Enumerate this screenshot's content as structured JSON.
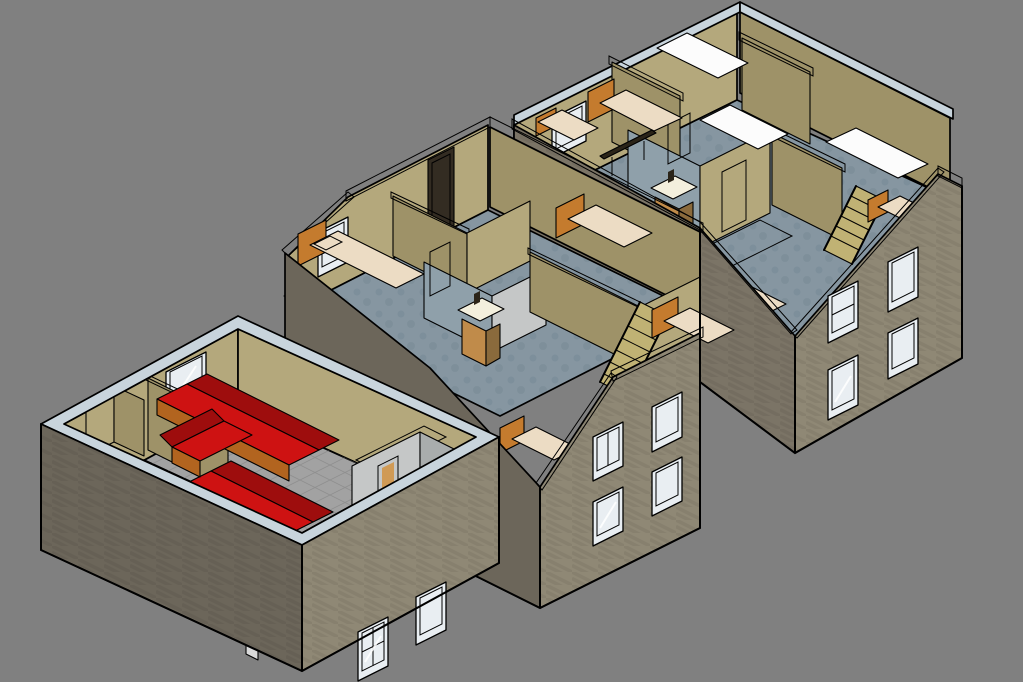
{
  "canvas": {
    "width": 1023,
    "height": 682,
    "background": "#808080"
  },
  "palette": {
    "bg": "#808080",
    "cap": "#c8d4dc",
    "white": "#ffffff",
    "ext_lit": "#8f8875",
    "ext_mid": "#7b7466",
    "ext_shade": "#6c665a",
    "tan_lit": "#b4a87c",
    "tan_shade": "#9e9268",
    "floor_gray": "#a2a2a2",
    "floor_grid": "#7f7f7f",
    "floor_blue": "#8696a1",
    "floor_blue_dark": "#72828c",
    "bath_int": "#8fa0aa",
    "bath_wall": "#c5c7c7",
    "bath_wall_shade": "#a9adad",
    "glass": "#a3b9c9",
    "glass_light": "#c4d1da",
    "glass_dark": "#7e98aa",
    "frame": "#e9eef2",
    "red_seat": "#ce1212",
    "red_back": "#9e0d0d",
    "base_orange": "#b2641f",
    "wood_table": "#c79a66",
    "wood_dark": "#8a6a3c",
    "mattress": "#ecdcc4",
    "headboard": "#c47b2e",
    "white_obj": "#fcfcfc",
    "white_obj_shade": "#d9d9d9",
    "olive": "#b0a245",
    "olive_shade": "#857a2e",
    "olive_door": "#a79a2f",
    "stair_tread": "#c0b274",
    "sink_wood": "#c08b4a",
    "sink_top": "#f3efdd",
    "door_dark": "#332c22",
    "door_glow": "#d09a55",
    "dark_obj": "#2b2418",
    "chair_dark": "#4a3b28"
  },
  "scene": {
    "description": "Isometric SketchUp-style cutaway render of three floors of a house displayed side by side on a gray background",
    "floors": [
      {
        "id": "ground-floor",
        "position": "bottom-left",
        "rooms": [
          "entry hall",
          "living room",
          "kitchen",
          "bathroom"
        ],
        "furniture": [
          "U-shaped red sofa group",
          "two wooden tables with chairs",
          "refrigerator",
          "olive kitchen counter with sink",
          "open double entry door"
        ],
        "windows": 3
      },
      {
        "id": "first-floor",
        "position": "middle",
        "rooms": [
          "bedroom",
          "bedroom",
          "bathroom",
          "bedroom",
          "hallway"
        ],
        "furniture": [
          "four single beds with orange headboards",
          "bathroom sink cabinet",
          "wooden staircase",
          "dark wall shelf",
          "glazed terrace door"
        ],
        "windows": 6
      },
      {
        "id": "attic-floor",
        "position": "top-right",
        "rooms": [
          "bedroom",
          "bathroom",
          "bedroom",
          "bedroom",
          "landing"
        ],
        "furniture": [
          "three white double beds",
          "two single beds",
          "bathroom sink cabinet",
          "wooden staircase"
        ],
        "windows": 5
      }
    ]
  }
}
